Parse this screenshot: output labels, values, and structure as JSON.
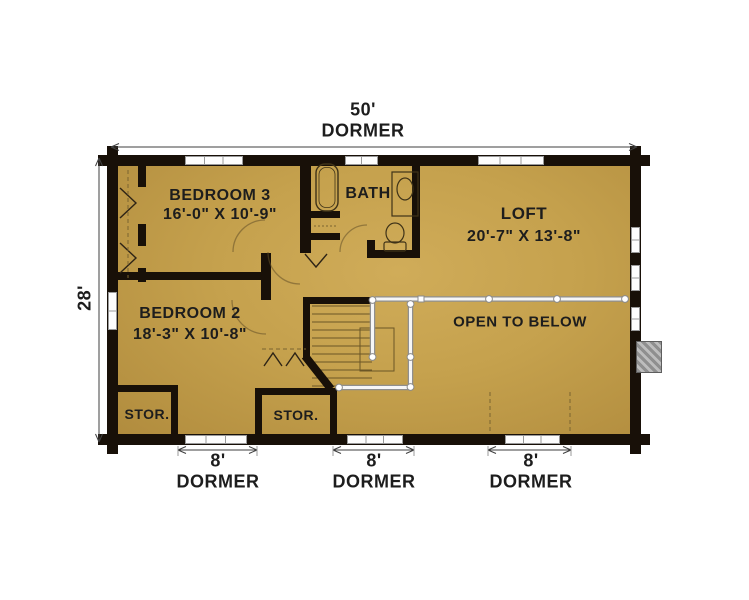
{
  "plan": {
    "overall_width_label": "50'",
    "overall_depth_label": "28'",
    "top_dormer_label": "DORMER"
  },
  "rooms": {
    "bedroom3": {
      "name": "BEDROOM 3",
      "size": "16'-0\" X 10'-9\""
    },
    "bath": {
      "name": "BATH"
    },
    "loft": {
      "name": "LOFT",
      "size": "20'-7\" X 13'-8\""
    },
    "bedroom2": {
      "name": "BEDROOM 2",
      "size": "18'-3\" X 10'-8\""
    },
    "open_to_below": {
      "name": "OPEN TO BELOW"
    },
    "storage_left": {
      "name": "STOR."
    },
    "storage_center": {
      "name": "STOR."
    }
  },
  "dormers": [
    {
      "width": "8'",
      "label": "DORMER"
    },
    {
      "width": "8'",
      "label": "DORMER"
    },
    {
      "width": "8'",
      "label": "DORMER"
    }
  ],
  "fixtures": [
    "bathtub",
    "sink",
    "toilet",
    "staircase",
    "railing",
    "chimney"
  ],
  "colors": {
    "floor": "#c5a14d",
    "walls": "#181008",
    "background": "#ffffff",
    "railing": "#f6f6f6",
    "chimney_hatch": "#9a9a9a",
    "text": "#1d1d1d"
  }
}
